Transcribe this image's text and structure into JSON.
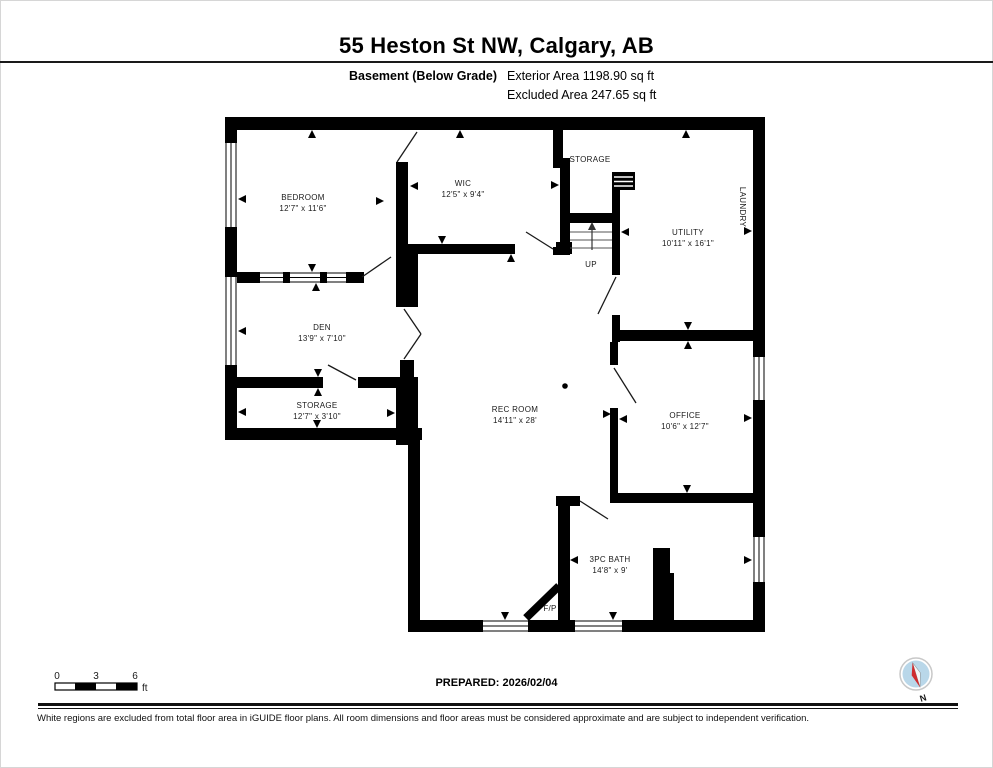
{
  "header": {
    "title": "55 Heston St NW, Calgary, AB",
    "floor_label": "Basement (Below Grade)",
    "exterior_area": "Exterior Area 1198.90 sq ft",
    "excluded_area": "Excluded Area 247.65 sq ft"
  },
  "floorplan": {
    "rooms": [
      {
        "name": "BEDROOM",
        "dims": "12'7\" x 11'6\""
      },
      {
        "name": "WIC",
        "dims": "12'5\" x 9'4\""
      },
      {
        "name": "STORAGE",
        "dims": ""
      },
      {
        "name": "UTILITY",
        "dims": "10'11\" x 16'1\""
      },
      {
        "name": "LAUNDRY",
        "dims": ""
      },
      {
        "name": "DEN",
        "dims": "13'9\" x 7'10\""
      },
      {
        "name": "STORAGE",
        "dims": "12'7\" x 3'10\""
      },
      {
        "name": "REC ROOM",
        "dims": "14'11\" x 28'"
      },
      {
        "name": "OFFICE",
        "dims": "10'6\" x 12'7\""
      },
      {
        "name": "3PC BATH",
        "dims": "14'8\" x 9'"
      }
    ],
    "labels": {
      "up": "UP",
      "fireplace": "F/P"
    }
  },
  "scale_bar": {
    "ticks": [
      "0",
      "3",
      "6"
    ],
    "unit": "ft"
  },
  "footer": {
    "prepared": "PREPARED: 2026/02/04",
    "disclaimer": "White regions are excluded from total floor area in iGUIDE floor plans. All room dimensions and floor areas must be considered approximate and are subject to independent verification.",
    "compass_label": "N"
  },
  "colors": {
    "wall": "#000000",
    "compass_fill": "#b9d7e9",
    "compass_red": "#cf2b2e",
    "compass_ring": "#c8c8c8"
  }
}
